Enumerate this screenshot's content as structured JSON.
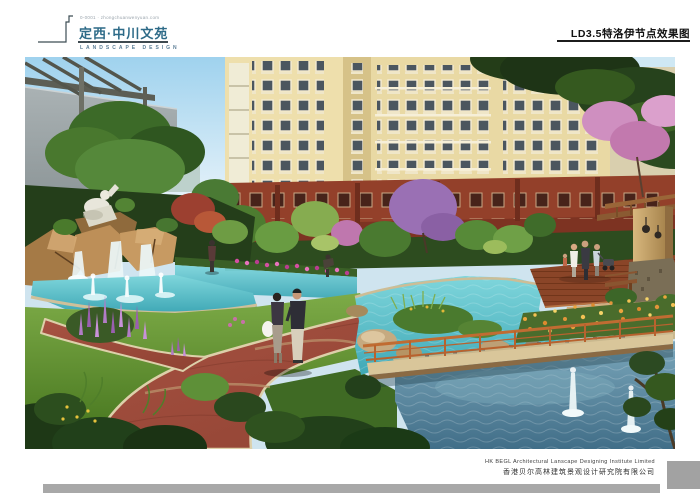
{
  "board": {
    "header": {
      "brand_tagline": "0-0001 · zhongchuanwenyuan.com",
      "project_title": "定西·中川文苑",
      "brand_subtitle": "LANDSCAPE DESIGN",
      "drawing_label": "LD3.5特洛伊节点效果图"
    },
    "footer": {
      "company_en": "HK BEGL Architectural Lanscape Designing Institute Limited",
      "company_zh": "香港贝尔高林建筑景观设计研究院有限公司"
    },
    "rendering": {
      "description": "Residential courtyard landscape rendering: turquoise pools with fountain jets, rock waterfall with white sculpture, curved red brick path with strolling couple, wooden foot bridge, timber deck with family group, tan landmark pillar with lanterns, purple and pink flowering trees, cream apartment towers over a red-brown podium.",
      "palette": {
        "sky_blue": "#9fd2ee",
        "building_cream": "#e9d9a4",
        "building_red": "#93402a",
        "pool_turquoise": "#4fb4c2",
        "pool_deep_blue": "#4a7a94",
        "path_red": "#9c4a38",
        "lawn_green": "#5d8f33",
        "rock_tan": "#b98a55",
        "accent_purple": "#9a70b4",
        "accent_pink": "#d44fa2",
        "bar_gray": "#a8a8a8",
        "title_teal": "#2e6b88"
      }
    }
  }
}
